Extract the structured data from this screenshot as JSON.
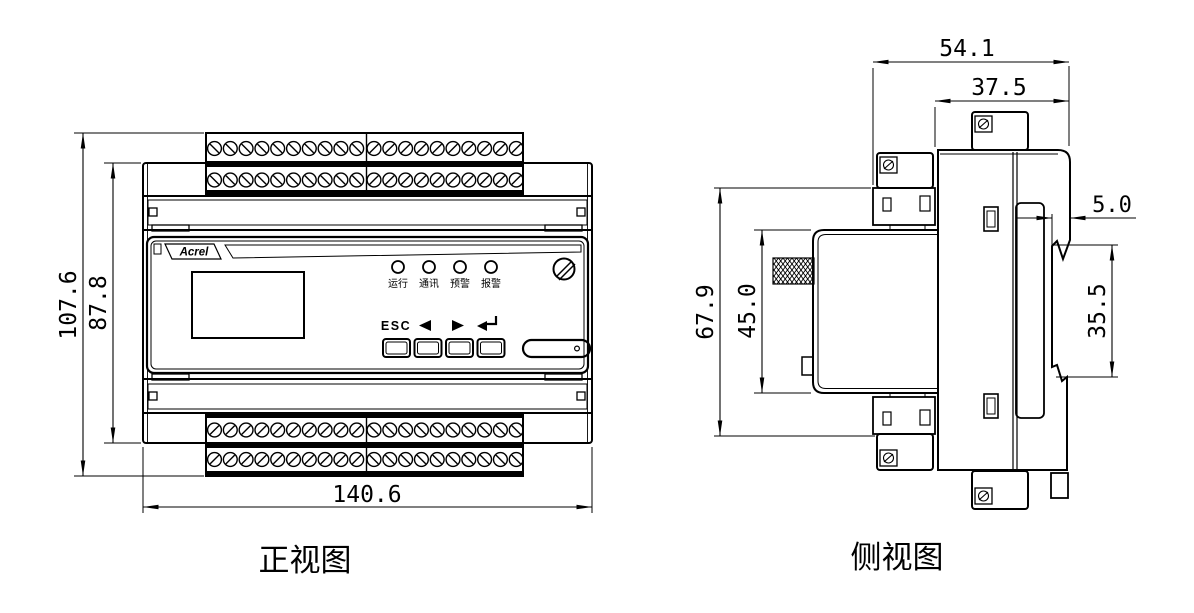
{
  "page": {
    "background": "#ffffff",
    "line_color": "#000000"
  },
  "front_view": {
    "caption": "正视图",
    "brand": "Acrel",
    "dimensions": {
      "total_height_mm": "107.6",
      "body_height_mm": "87.8",
      "total_width_mm": "140.6"
    },
    "leds": [
      "运行",
      "通讯",
      "预警",
      "报警"
    ],
    "buttons": {
      "esc": "ESC"
    },
    "terminals": {
      "rows_per_block": 2,
      "groups_per_row": 2,
      "screws_per_group": 10
    }
  },
  "side_view": {
    "caption": "侧视图",
    "dimensions": {
      "total_depth_mm": "54.1",
      "body_depth_mm": "37.5",
      "rail_hook_mm": "5.0",
      "mid_height_mm": "67.9",
      "front_height_mm": "45.0",
      "rail_slot_mm": "35.5"
    }
  }
}
